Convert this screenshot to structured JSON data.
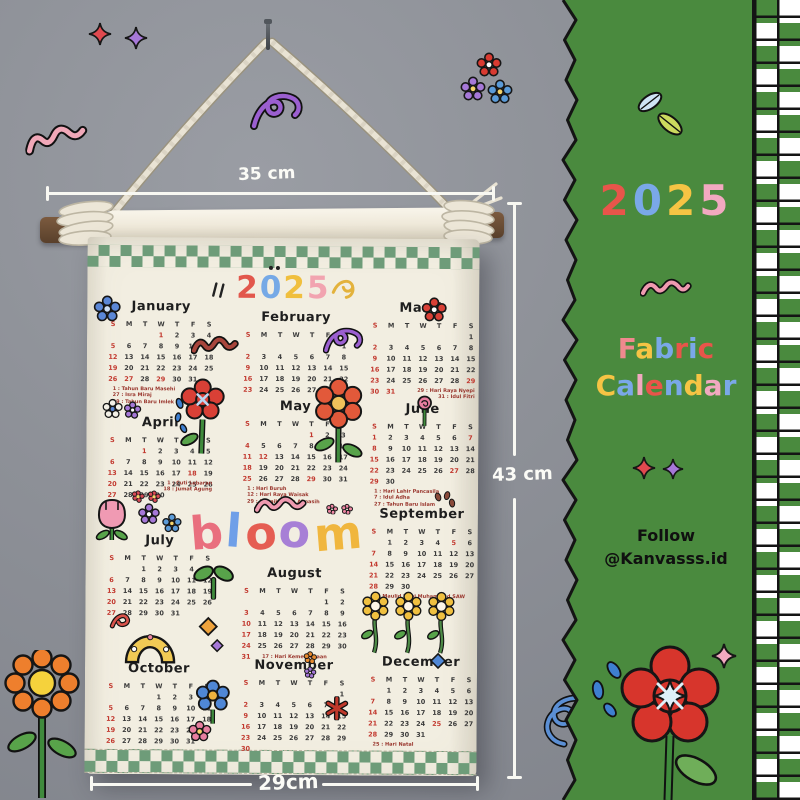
{
  "sidebar": {
    "year": {
      "text": "2025",
      "colors": [
        "#e8554a",
        "#7aa8e8",
        "#f6c444",
        "#f2a9c0"
      ]
    },
    "wordmark": [
      {
        "text": "Fabric",
        "colors": [
          "#f0898e",
          "#f6c444",
          "#7aa8e8",
          "#e8554a",
          "#7aa8e8",
          "#e8554a"
        ]
      },
      {
        "text": "Calendar",
        "colors": [
          "#f6c444",
          "#7aa8e8",
          "#f2a9c0",
          "#e8554a",
          "#7aa8e8",
          "#f6c444",
          "#f2a9c0",
          "#7aa8e8"
        ]
      }
    ],
    "follow": {
      "line1": "Follow",
      "line2": "@Kanvasss.id"
    },
    "colors": {
      "panel": "#4a8a3e",
      "checker_white": "#ffffff"
    }
  },
  "measurements": {
    "top_width": "35 cm",
    "side_height": "43 cm",
    "bottom_width": "29cm"
  },
  "calendar": {
    "year": {
      "text": "2025",
      "colors": [
        "#e2574c",
        "#76a9e6",
        "#f0bf3e",
        "#f2a4b0"
      ]
    },
    "bloom": {
      "text": "bloom",
      "colors": [
        "#e96f7e",
        "#6f9fe8",
        "#e55d52",
        "#a77fd6",
        "#f0b63e"
      ]
    },
    "dow": [
      "S",
      "M",
      "T",
      "W",
      "T",
      "F",
      "S"
    ],
    "months": [
      {
        "name": "January",
        "start": 3,
        "days": 31,
        "red": [
          1,
          5,
          12,
          19,
          26,
          27,
          29
        ],
        "notes": [
          "1 : Tahun Baru Masehi",
          "27 : Isra Miraj",
          "29 : Tahun Baru Imlek"
        ]
      },
      {
        "name": "February",
        "start": 6,
        "days": 28,
        "red": [
          2,
          9,
          16,
          23
        ],
        "notes": []
      },
      {
        "name": "March",
        "start": 6,
        "days": 31,
        "red": [
          2,
          9,
          16,
          23,
          29,
          30,
          31
        ],
        "notes": [
          "29 : Hari Raya Nyepi",
          "31 : Idul Fitri"
        ]
      },
      {
        "name": "April",
        "start": 2,
        "days": 30,
        "red": [
          1,
          6,
          13,
          18,
          20,
          27
        ],
        "notes": [
          "1 : Cuti Lebaran",
          "18 : Jumat Agung"
        ]
      },
      {
        "name": "May",
        "start": 4,
        "days": 31,
        "red": [
          1,
          4,
          11,
          12,
          18,
          25,
          29
        ],
        "notes": [
          "1 : Hari Buruh",
          "12 : Hari Raya Waisak",
          "29 : Kenaikan Isa Almasih"
        ]
      },
      {
        "name": "June",
        "start": 0,
        "days": 30,
        "red": [
          1,
          7,
          8,
          15,
          22,
          27,
          29
        ],
        "notes": [
          "1 : Hari Lahir Pancasila",
          "7 : Idul Adha",
          "27 : Tahun Baru Islam"
        ]
      },
      {
        "name": "July",
        "start": 2,
        "days": 31,
        "red": [
          6,
          13,
          20,
          27
        ],
        "notes": []
      },
      {
        "name": "August",
        "start": 5,
        "days": 31,
        "red": [
          3,
          10,
          17,
          24,
          31
        ],
        "notes": [
          "17 : Hari Kemerdekaan"
        ]
      },
      {
        "name": "September",
        "start": 1,
        "days": 30,
        "red": [
          5,
          7,
          14,
          21,
          28
        ],
        "notes": [
          "5 : Maulid Nabi Muhammad SAW"
        ]
      },
      {
        "name": "October",
        "start": 3,
        "days": 31,
        "red": [
          5,
          12,
          19,
          26
        ],
        "notes": []
      },
      {
        "name": "November",
        "start": 6,
        "days": 30,
        "red": [
          2,
          9,
          16,
          23,
          30
        ],
        "notes": []
      },
      {
        "name": "December",
        "start": 1,
        "days": 31,
        "red": [
          7,
          14,
          21,
          25,
          28
        ],
        "notes": [
          "25 : Hari Natal"
        ]
      }
    ]
  },
  "decorations": [
    "nail",
    "rope",
    "wooden-dowel",
    "flowers",
    "stars",
    "squiggles",
    "sparkles",
    "leaves",
    "daisies",
    "tulip",
    "sprout",
    "arch"
  ]
}
